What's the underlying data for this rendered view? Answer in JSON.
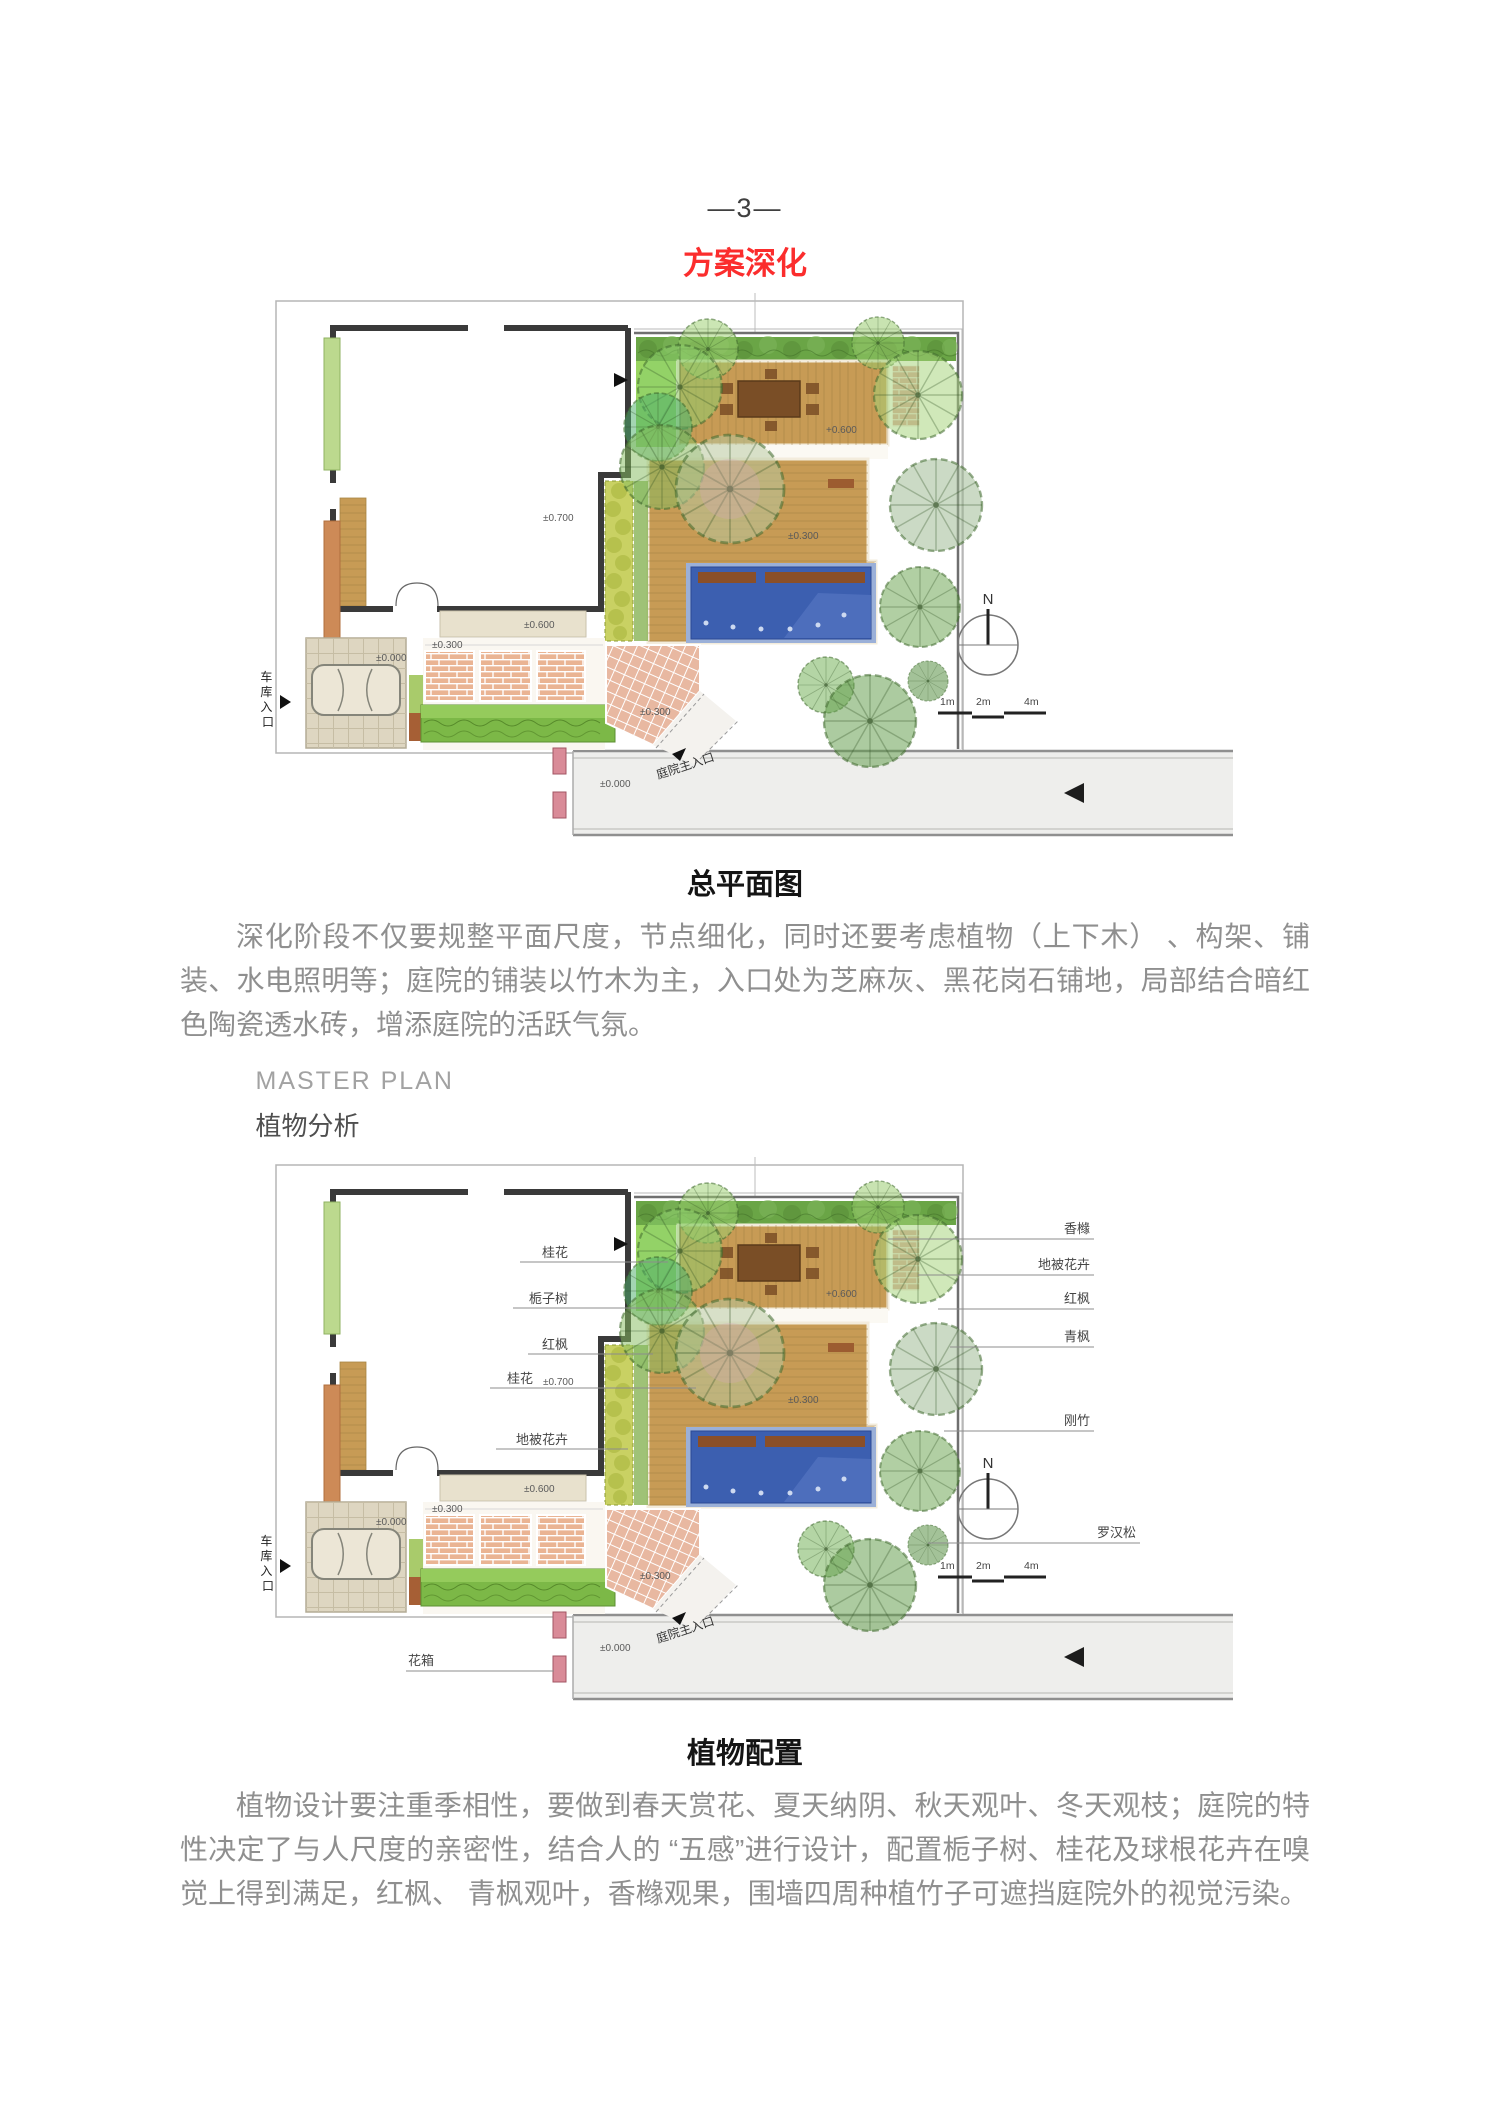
{
  "page": {
    "page_number": "—3—",
    "section_title": "方案深化"
  },
  "figure1": {
    "caption": "总平面图"
  },
  "paragraph1": "深化阶段不仅要规整平面尺度，节点细化，同时还要考虑植物（上下木） 、构架、铺装、水电照明等；庭院的铺装以竹木为主，入口处为芝麻灰、黑花岗石铺地，局部结合暗红色陶瓷透水砖，增添庭院的活跃气氛。",
  "figure2": {
    "title_en": "MASTER PLAN",
    "title_cn": "植物分析",
    "caption": "植物配置"
  },
  "paragraph2": "植物设计要注重季相性，要做到春天赏花、夏天纳阴、秋天观叶、冬天观枝；庭院的特性决定了与人尺度的亲密性，结合人的 “五感”进行设计，配置栀子树、桂花及球根花卉在嗅觉上得到满足，红枫、 青枫观叶，香橼观果，围墙四周种植竹子可遮挡庭院外的视觉污染。",
  "plan_labels": {
    "north": "N",
    "scale": [
      "1m",
      "2m",
      "4m"
    ],
    "elev_house": "±0.700",
    "elev_porch": "±0.600",
    "elev_upper_deck": "+0.600",
    "elev_mid_deck": "±0.300",
    "elev_paving": "±0.300",
    "elev_entry_paving": "±0.300",
    "elev_garage": "±0.000",
    "elev_road": "±0.000",
    "garage_entrance_chars": [
      "车",
      "库",
      "入",
      "口"
    ],
    "main_entrance": "庭院主入口"
  },
  "plant_callouts": {
    "left": [
      "桂花",
      "栀子树",
      "红枫",
      "桂花",
      "地被花卉"
    ],
    "right": [
      "香橼",
      "地被花卉",
      "红枫",
      "青枫",
      "刚竹",
      "罗汉松"
    ],
    "flower_box": "花箱"
  },
  "colors": {
    "accent": "#fb2d2d",
    "body_text": "#8f8f8f",
    "caption": "#141414",
    "pool_blue": "#3c5fb0",
    "deck_wood": "#c79b55",
    "hedge_green": "#6aa546"
  }
}
